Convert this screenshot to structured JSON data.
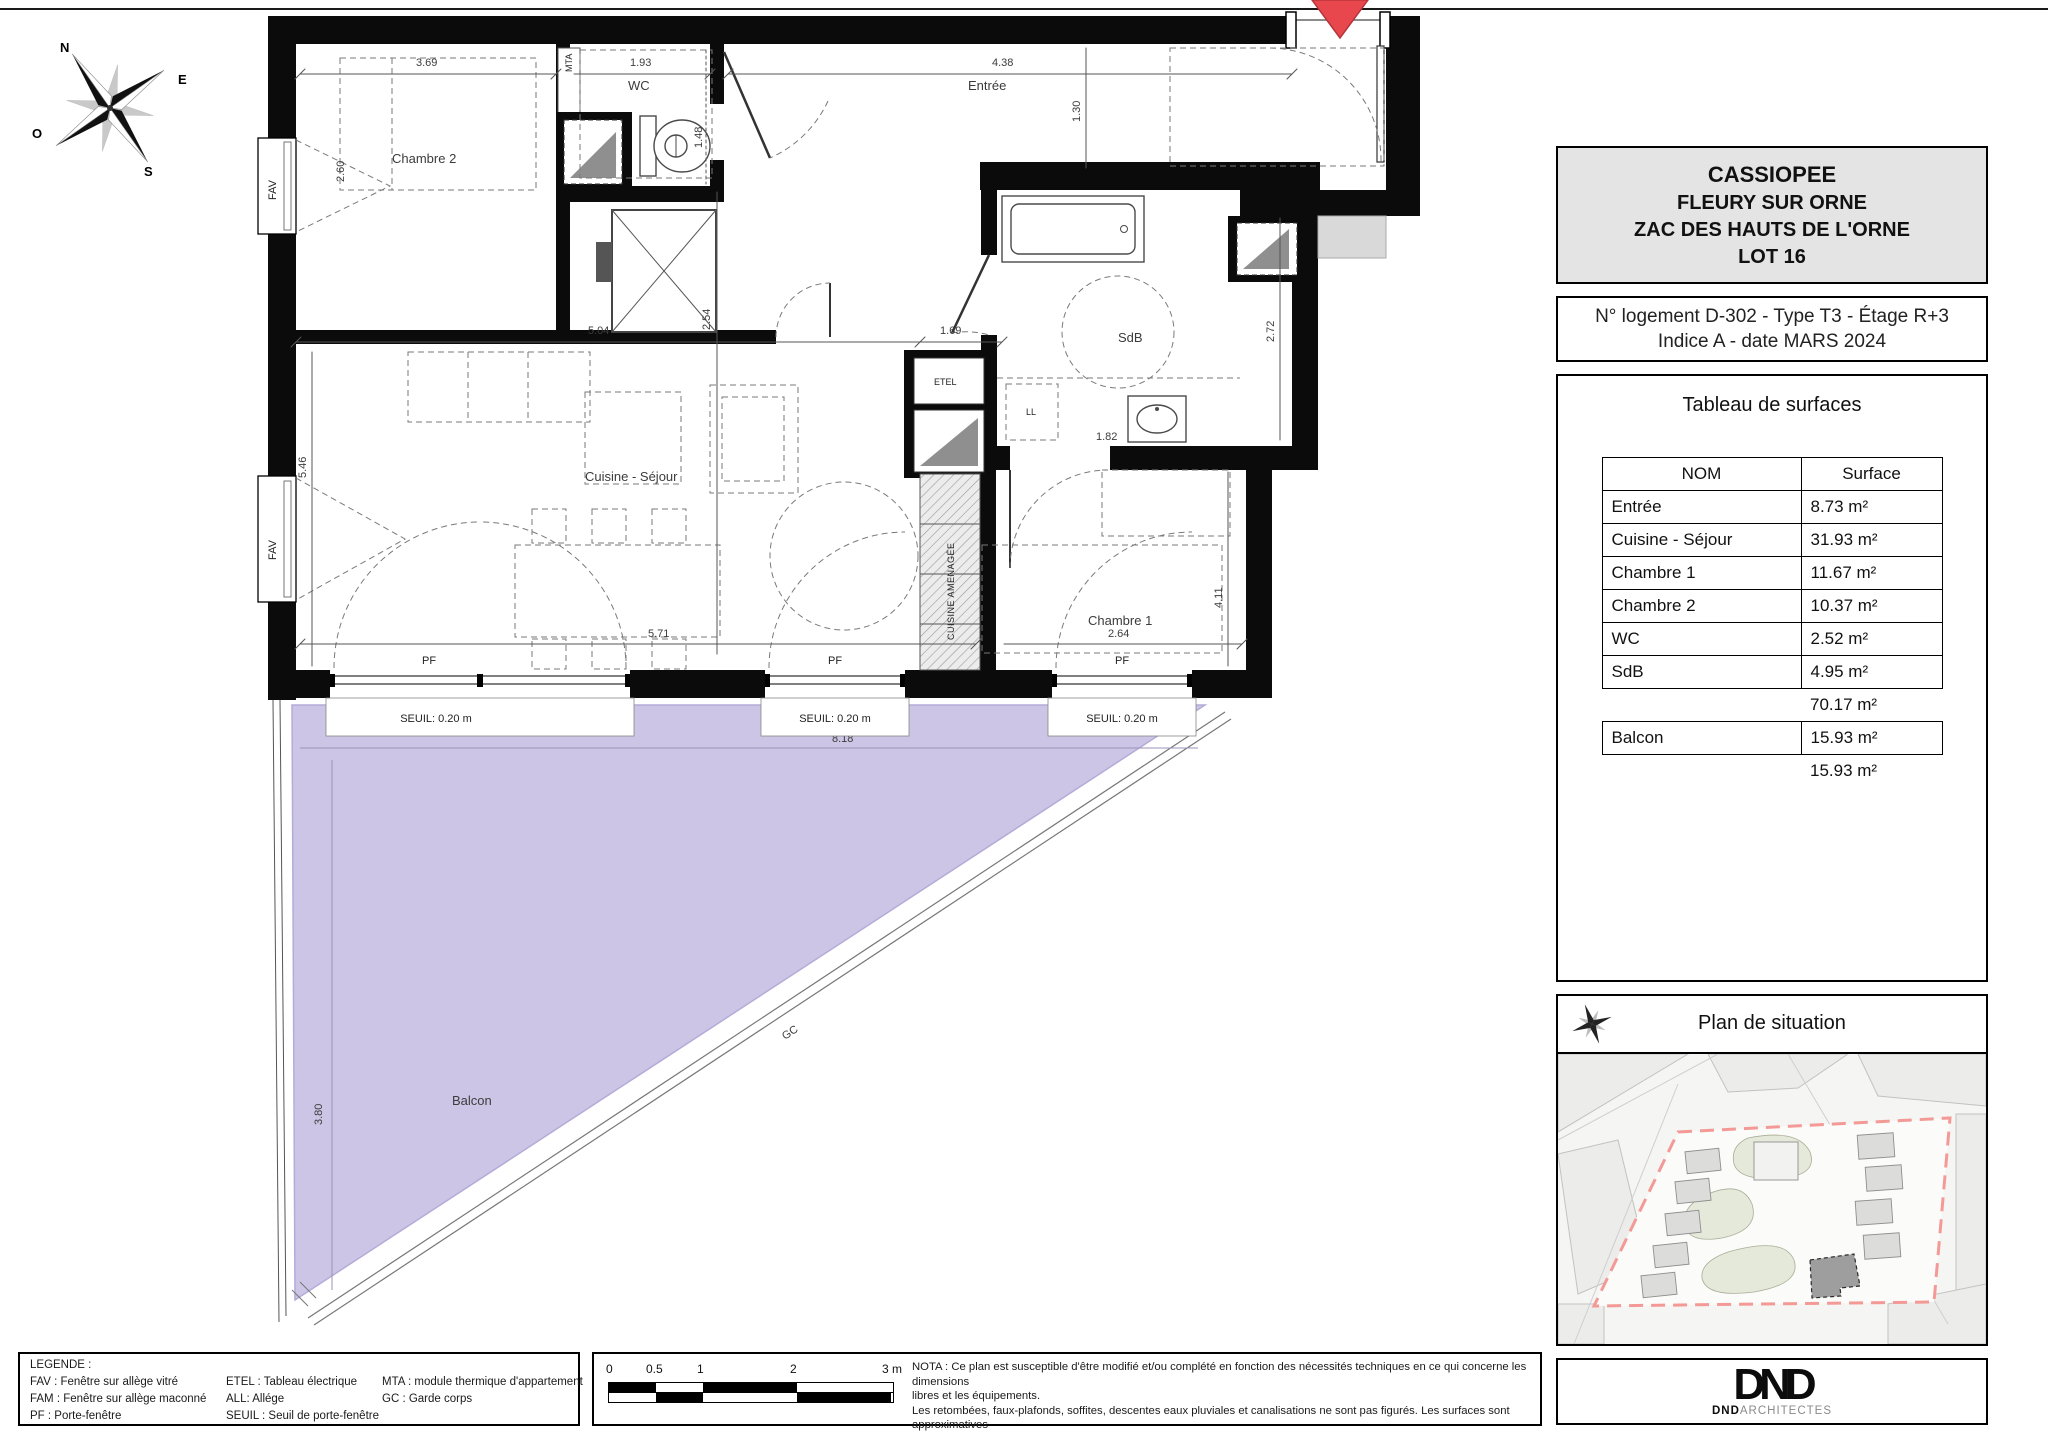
{
  "title_block": {
    "line1": "CASSIOPEE",
    "line2": "FLEURY SUR ORNE",
    "line3": "ZAC DES HAUTS DE L'ORNE",
    "line4": "LOT 16"
  },
  "info_block": {
    "line1": "N° logement D-302 -  Type T3 -  Étage R+3",
    "line2": "Indice A -  date MARS 2024"
  },
  "surface_table": {
    "title": "Tableau de surfaces",
    "columns": {
      "name": "NOM",
      "surface": "Surface"
    },
    "rows": [
      {
        "name": "Entrée",
        "surface": "8.73 m²"
      },
      {
        "name": "Cuisine - Séjour",
        "surface": "31.93 m²"
      },
      {
        "name": "Chambre 1",
        "surface": "11.67 m²"
      },
      {
        "name": "Chambre 2",
        "surface": "10.37 m²"
      },
      {
        "name": "WC",
        "surface": "2.52 m²"
      },
      {
        "name": "SdB",
        "surface": "4.95 m²"
      }
    ],
    "subtotal": "70.17 m²",
    "balcony": {
      "name": "Balcon",
      "surface": "15.93 m²"
    },
    "balcony_total": "15.93 m²"
  },
  "situation": {
    "title": "Plan de situation"
  },
  "legend": {
    "title": "LEGENDE :",
    "col1": [
      "FAV : Fenêtre sur allège vitré",
      "FAM : Fenêtre sur allège maconné",
      "PF :  Porte-fenêtre"
    ],
    "col2": [
      "ETEL : Tableau électrique",
      "ALL: Allége",
      "SEUIL : Seuil de porte-fenêtre"
    ],
    "col3": [
      "MTA : module thermique d'appartement",
      "GC : Garde corps"
    ]
  },
  "scalebar": {
    "t0": "0",
    "t05": "0.5",
    "t1": "1",
    "t2": "2",
    "t3": "3 m"
  },
  "nota": {
    "line1": "NOTA : Ce plan est susceptible d'être modifié et/ou complété en fonction des nécessités techniques en ce qui concerne les dimensions",
    "line2": "libres et les équipements.",
    "line3": "Les retombées, faux-plafonds, soffites, descentes eaux pluviales et canalisations ne sont pas figurés. Les surfaces sont approximatives"
  },
  "logo": {
    "mark": "DND",
    "bold": "DND",
    "rest": "ARCHITECTES"
  },
  "compass": {
    "n": "N",
    "e": "E",
    "s": "S",
    "o": "O"
  },
  "plan": {
    "rooms": {
      "chambre2": "Chambre 2",
      "wc": "WC",
      "entree": "Entrée",
      "sdb": "SdB",
      "chambre1": "Chambre 1",
      "sejour": "Cuisine - Séjour",
      "balcon": "Balcon"
    },
    "dims": {
      "d369": "3.69",
      "d193": "1.93",
      "d438": "4.38",
      "d130": "1.30",
      "d260": "2.60",
      "d148": "1.48",
      "d254": "2.54",
      "d272": "2.72",
      "d182": "1.82",
      "d504": "5.04",
      "d169": "1.69",
      "d546": "5.46",
      "d411": "4.11",
      "d571": "5.71",
      "d264": "2.64",
      "d818": "8.18",
      "d380": "3.80"
    },
    "tags": {
      "fav": "FAV",
      "pf": "PF",
      "seuil": "SEUIL: 0.20 m",
      "etel": "ETEL",
      "mta": "MTA",
      "ll": "LL",
      "gc": "GC",
      "cuisine": "CUISINE AMENAGÉE"
    }
  }
}
